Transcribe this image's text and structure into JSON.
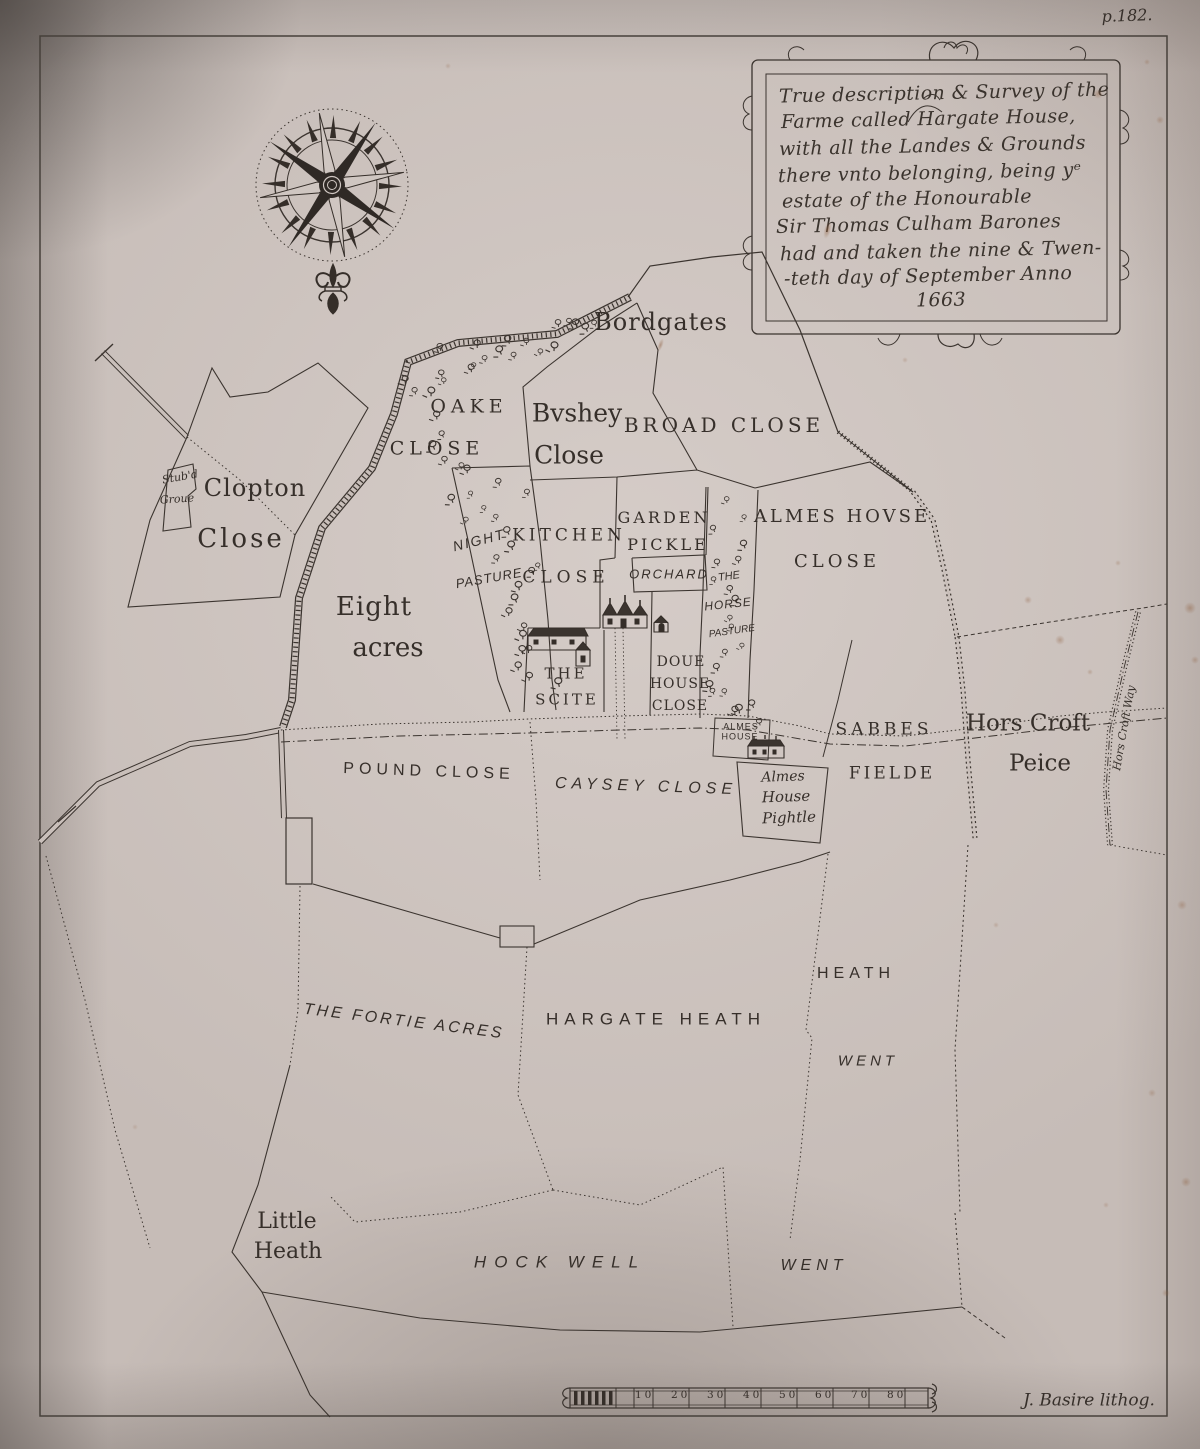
{
  "page": {
    "number": "p.182.",
    "signature": "J. Basire lithog."
  },
  "cartouche": {
    "lines": [
      "True description & Survey of the",
      "Farme called Hargate House,",
      "with all the Landes & Grounds",
      "there vnto belonging, being yᵉ",
      "estate of the Honourable",
      "Sir Thomas Culham Barones",
      "had and taken the nine & Twen-",
      "-teth day of September Anno",
      "1663"
    ]
  },
  "labels": {
    "bordgates": "Bordgates",
    "oake_1": "OAKE",
    "oake_2": "CLOSE",
    "byshey_1": "Bvshey",
    "byshey_2": "Close",
    "broad": "BROAD CLOSE",
    "clopton_1": "Clopton",
    "clopton_2": "Close",
    "stubd_1": "Stub'd",
    "stubd_2": "Groue",
    "night_1": "NIGHT",
    "night_2": "PASTURE",
    "kitchen_1": "KITCHEN",
    "kitchen_2": "CLOSE",
    "garden_1": "GARDEN",
    "garden_2": "PICKLE",
    "orchard": "ORCHARD",
    "horse_1": "THE",
    "horse_2": "HORSE",
    "horse_3": "PASTURE",
    "almes_close_1": "ALMES HOVSE",
    "almes_close_2": "CLOSE",
    "eight_1": "Eight",
    "eight_2": "acres",
    "scite_1": "THE",
    "scite_2": "SCITE",
    "doue_1": "DOUE",
    "doue_2": "HOUSE",
    "doue_3": "CLOSE",
    "almes_house_1": "ALMES",
    "almes_house_2": "HOUSE",
    "sabbes_1": "SABBES",
    "sabbes_2": "FIELDE",
    "horscroft_1": "Hors Croft",
    "horscroft_2": "Peice",
    "pound": "POUND CLOSE",
    "caysey": "CAYSEY CLOSE",
    "pightle_1": "Almes",
    "pightle_2": "House",
    "pightle_3": "Pightle",
    "horscroft_way": "Hors Croft Way",
    "fortie": "THE FORTIE ACRES",
    "hargate_heath": "HARGATE HEATH",
    "heath": "HEATH",
    "went_ne": "WENT",
    "little_1": "Little",
    "little_2": "Heath",
    "hockwell": "HOCK WELL",
    "went_s": "WENT"
  },
  "scale_bar": {
    "ticks": [
      "10",
      "20",
      "30",
      "40",
      "50",
      "60",
      "70",
      "80"
    ]
  },
  "colors": {
    "paper": "#c6bcb7",
    "ink": "#3b342f",
    "foxing": "#8e5f3f"
  }
}
